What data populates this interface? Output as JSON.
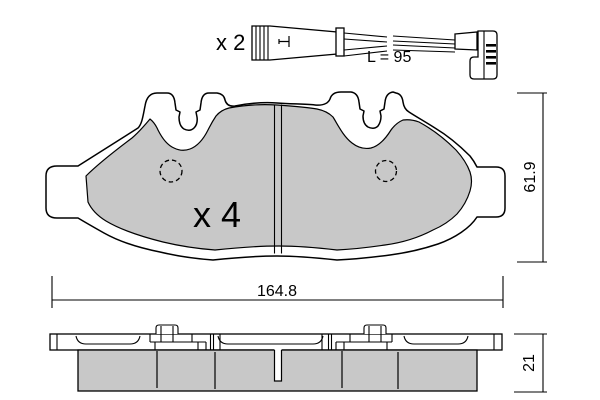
{
  "sensor": {
    "quantity": "x 2",
    "length_label": "L = 95"
  },
  "pad": {
    "quantity": "x 4"
  },
  "dims": {
    "width": "164.8",
    "height": "61.9",
    "thickness": "21"
  },
  "colors": {
    "friction": "#c8c8c8",
    "line": "#000000",
    "background": "#ffffff"
  }
}
